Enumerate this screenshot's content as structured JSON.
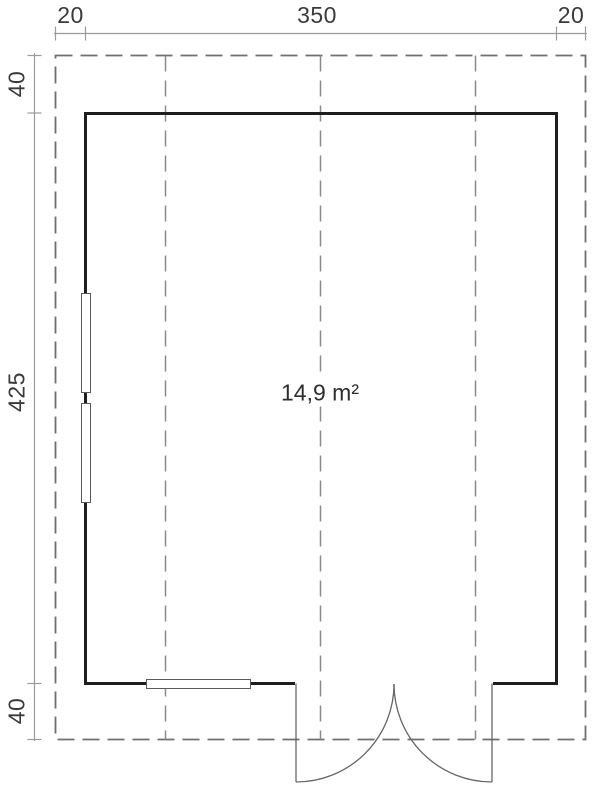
{
  "area": {
    "label": "14,9 m²"
  },
  "dimensions": {
    "top": {
      "left_overhang": "20",
      "width": "350",
      "right_overhang": "20"
    },
    "side": {
      "top_overhang": "40",
      "depth": "425",
      "bottom_overhang": "40"
    }
  },
  "colors": {
    "wall": "#1e1e1e",
    "overhang_dash": "#6f6f6f",
    "beam_dash": "#8a8a8a",
    "dimension_line": "#9b9b9b",
    "window_frame": "#5a5a5a",
    "door": "#666666",
    "text": "#3a3a3a"
  }
}
